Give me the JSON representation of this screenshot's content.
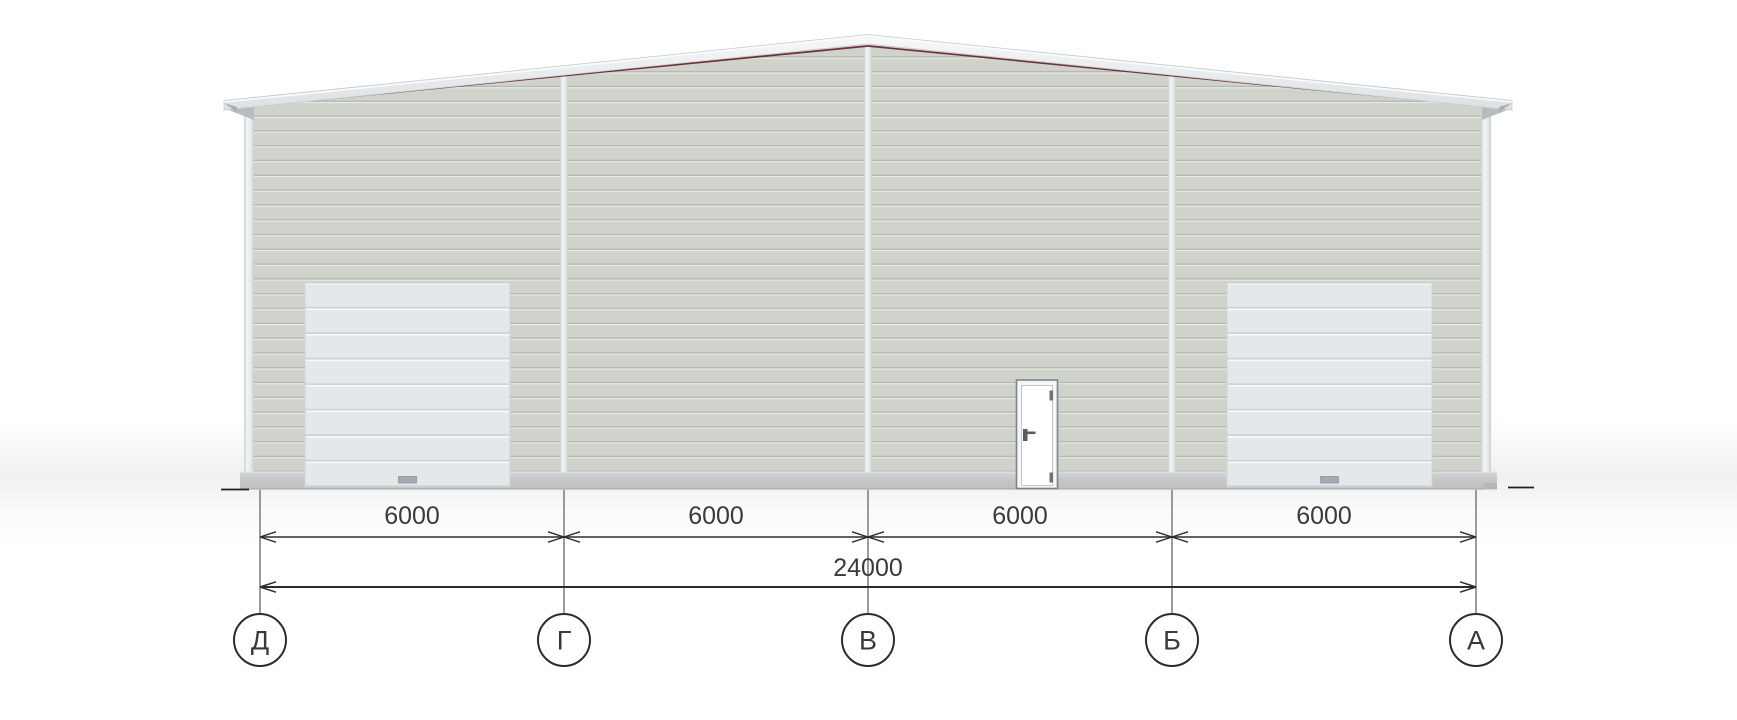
{
  "drawing": {
    "view_name": "building-front-elevation",
    "axis_labels": [
      "Д",
      "Г",
      "В",
      "Б",
      "А"
    ],
    "bay_dimensions": [
      "6000",
      "6000",
      "6000",
      "6000"
    ],
    "overall_dimension": "24000",
    "colors": {
      "wall_siding": "#cfd3cb",
      "siding_groove": "#b5b9b1",
      "gate_panel": "#e4e8eb",
      "white_trim": "#edf0f2",
      "roof_edge_accent": "#703236",
      "plinth_concrete": "#c6c8c9",
      "dimension_ink": "#2e2e2e",
      "background": "#ffffff"
    }
  }
}
